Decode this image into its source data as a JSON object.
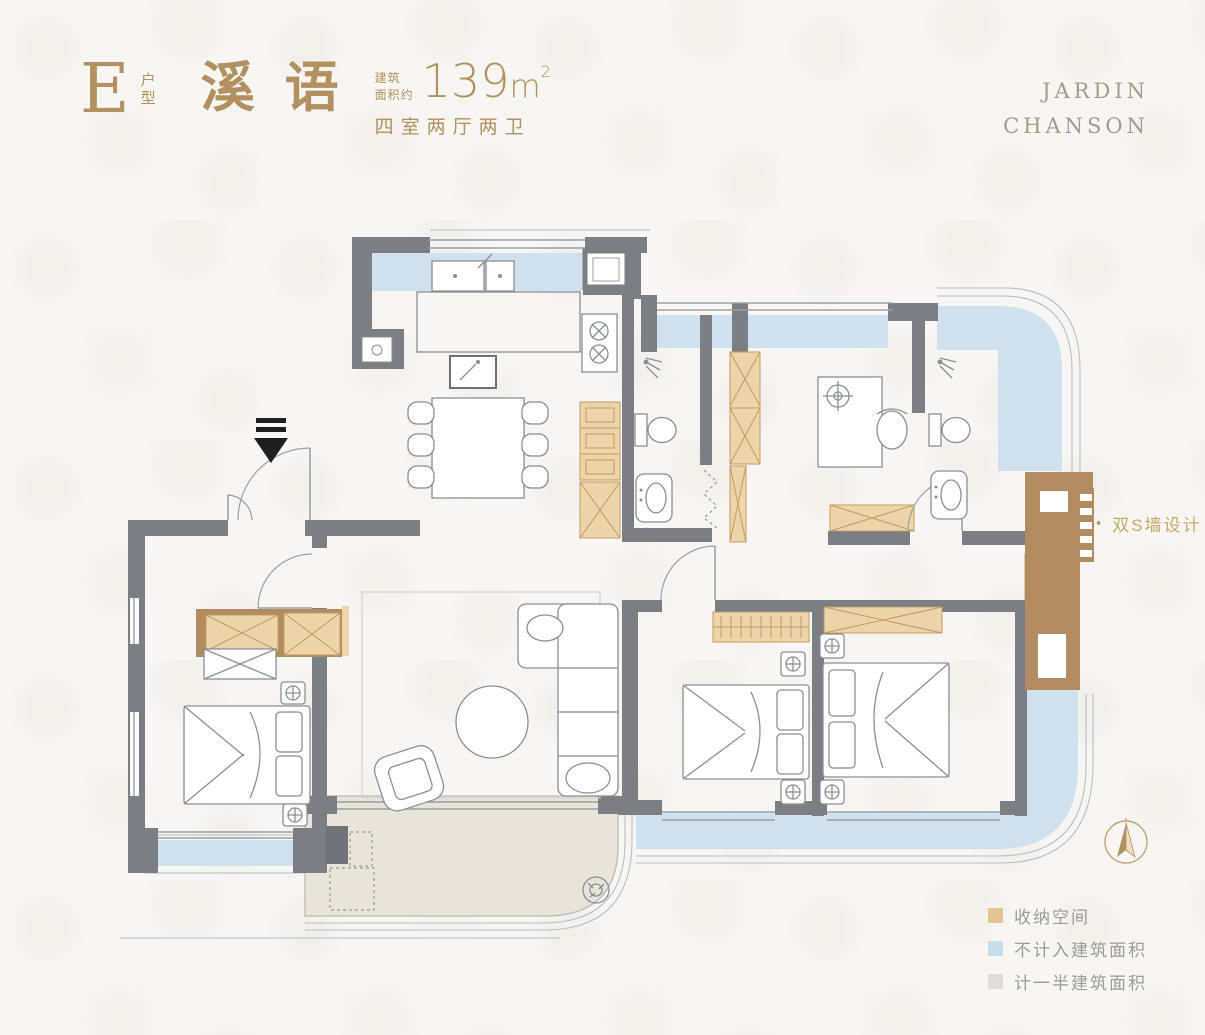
{
  "header": {
    "unit_letter": "E",
    "unit_type": "户型",
    "name": "溪语",
    "area_label_line1": "建筑",
    "area_label_line2": "面积约",
    "area_value": "139",
    "area_unit": "m",
    "area_superscript": "2",
    "layout_text": "四室两厅两卫"
  },
  "brand": {
    "line1": "JARDIN",
    "line2": "CHANSON"
  },
  "annotation": {
    "bullet": "•",
    "text": "双S墙设计"
  },
  "legend": {
    "items": [
      {
        "label": "收纳空间",
        "color": "#e3c492"
      },
      {
        "label": "不计入建筑面积",
        "color": "#c9dcea"
      },
      {
        "label": "计一半建筑面积",
        "color": "#deddd6"
      }
    ]
  },
  "icons": {
    "compass": "north-arrow-compass",
    "entry": "entrance-arrow",
    "shower": "shower-head",
    "stove": "two-burner-stove"
  },
  "colors": {
    "accent_gold": "#b2905f",
    "brand_gold_gray": "#a79a88",
    "annotation_gold": "#c9a86a",
    "wall_gray": "#7b7e83",
    "storage_tan": "#eed4ab",
    "storage_brown": "#b08c60",
    "balcony_blue": "#cfe0ee",
    "half_area_beige": "#e8e4da",
    "legend_text_gray": "#9b9b98",
    "entry_arrow_black": "#1f1f1f"
  }
}
